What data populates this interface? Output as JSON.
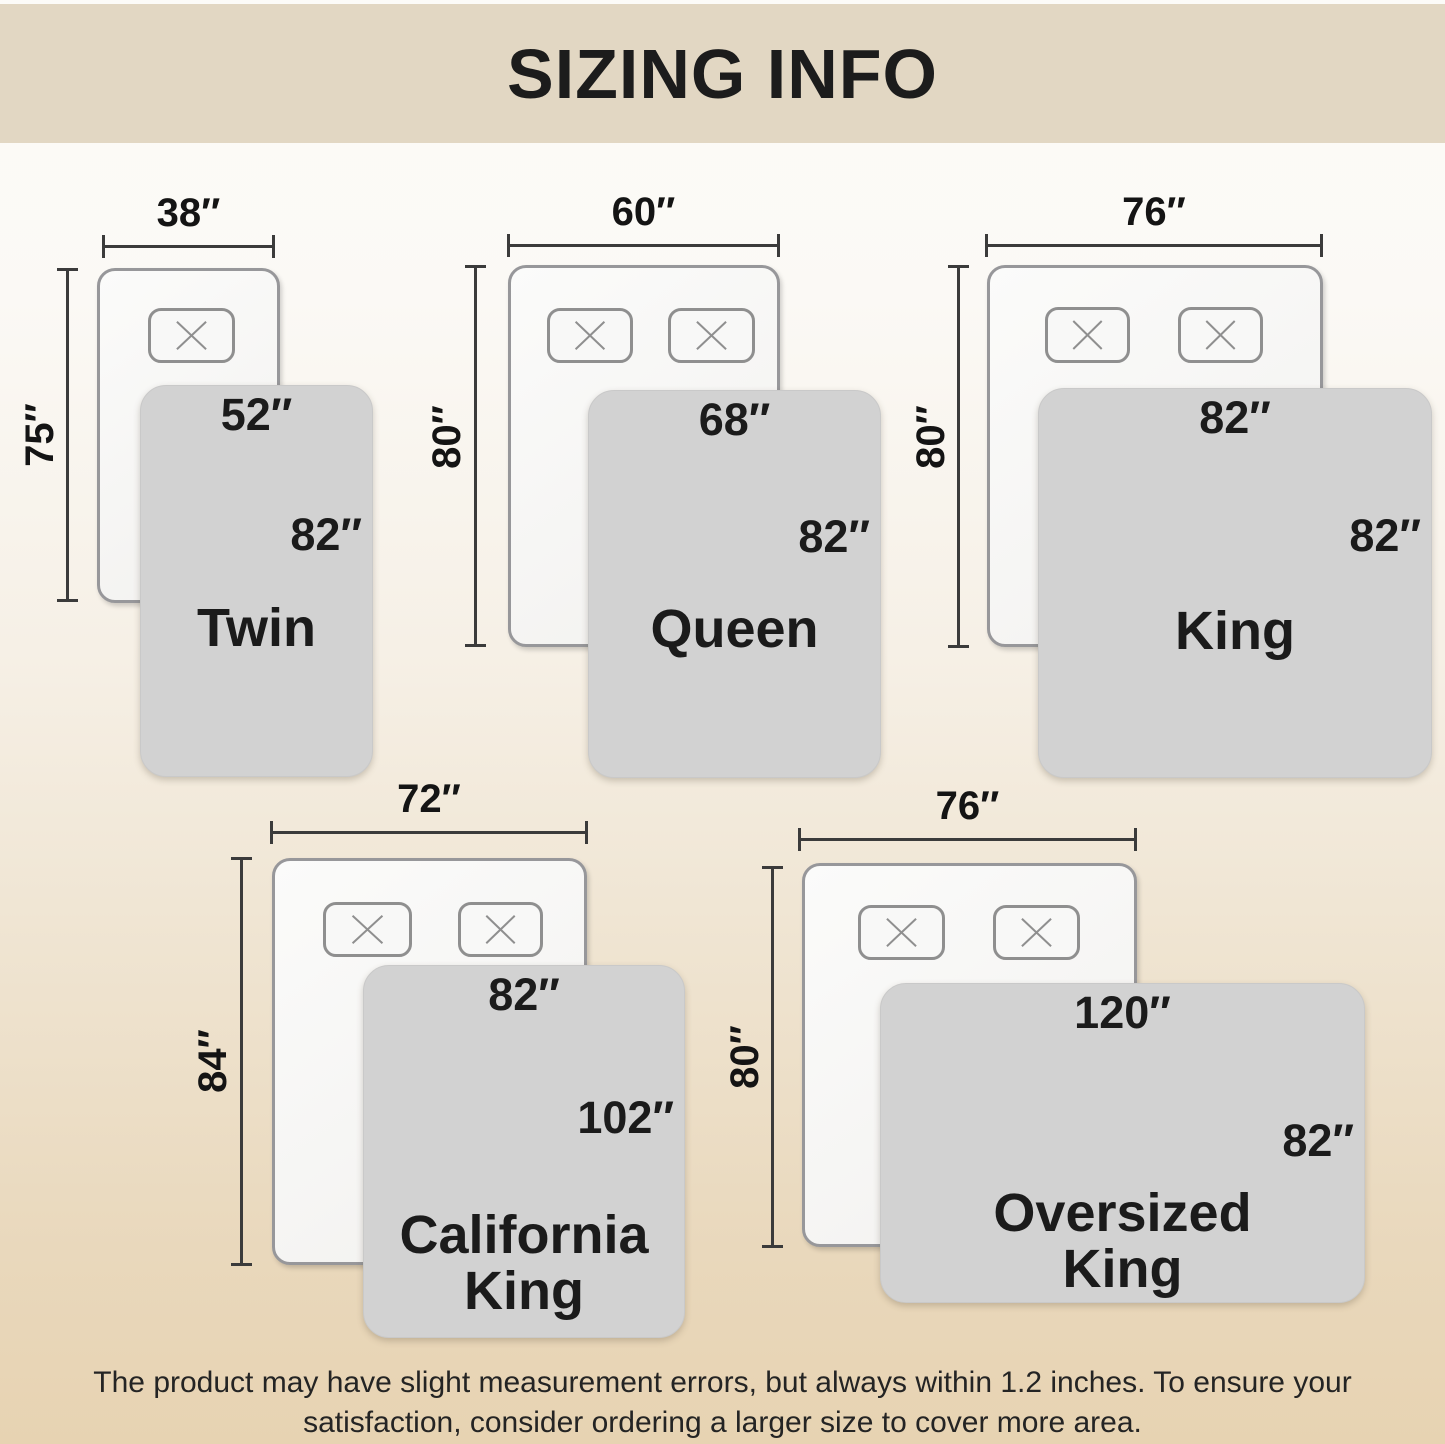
{
  "header": {
    "title": "SIZING INFO"
  },
  "beds": [
    {
      "name_line1": "Twin",
      "name_line2": "",
      "mattress_width": "38″",
      "mattress_height": "75″",
      "blanket_width": "52″",
      "blanket_height": "82″"
    },
    {
      "name_line1": "Queen",
      "name_line2": "",
      "mattress_width": "60″",
      "mattress_height": "80″",
      "blanket_width": "68″",
      "blanket_height": "82″"
    },
    {
      "name_line1": "King",
      "name_line2": "",
      "mattress_width": "76″",
      "mattress_height": "80″",
      "blanket_width": "82″",
      "blanket_height": "82″"
    },
    {
      "name_line1": "California",
      "name_line2": "King",
      "mattress_width": "72″",
      "mattress_height": "84″",
      "blanket_width": "82″",
      "blanket_height": "102″"
    },
    {
      "name_line1": "Oversized",
      "name_line2": "King",
      "mattress_width": "76″",
      "mattress_height": "80″",
      "blanket_width": "120″",
      "blanket_height": "82″"
    }
  ],
  "footer": {
    "line1": "The product may have slight measurement errors, but always within 1.2 inches. To ensure your",
    "line2": "satisfaction, consider ordering a larger size to cover more area."
  },
  "colors": {
    "header_bg": "#e2d7c3",
    "page_top": "#fcfbf8",
    "page_bottom": "#e7d3b2",
    "blanket_fill": "#d2d2d2",
    "mattress_fill": "#f7f6f4",
    "outline_gray": "#8f8f8f",
    "dimension_line": "#3b3b3b",
    "text": "#1b1b1b"
  }
}
